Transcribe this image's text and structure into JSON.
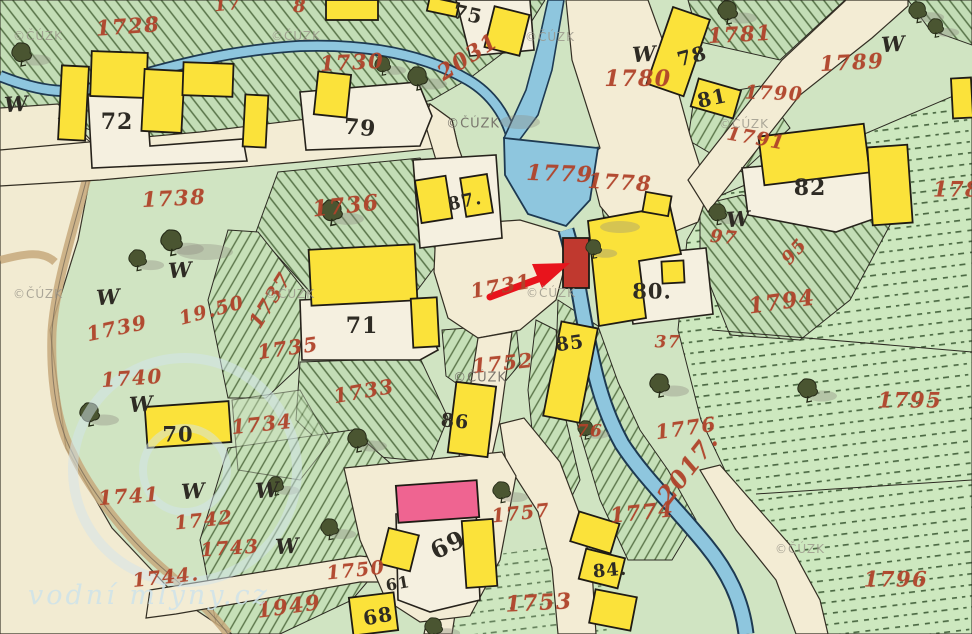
{
  "map": {
    "type": "historic-cadastral-map",
    "colors": {
      "building_wood_yellow": "#fbe23a",
      "building_masonry_pink": "#ef6491",
      "highlight_building_red": "#c0392f",
      "stream_blue": "#8ec6de",
      "field_green": "#cfe3bf",
      "road_cream": "#f3ecd4",
      "parcel_number_red": "#b0432a",
      "house_number_black": "#2e2b24",
      "arrow_red": "#e8141c"
    },
    "parcel_numbers_red": [
      {
        "t": "1728",
        "x": 128,
        "y": 26,
        "r": -4,
        "s": 21
      },
      {
        "t": "17",
        "x": 228,
        "y": 5,
        "r": -5,
        "s": 18
      },
      {
        "t": "8",
        "x": 300,
        "y": 7,
        "r": 0,
        "s": 18
      },
      {
        "t": "1730",
        "x": 352,
        "y": 62,
        "r": -3,
        "s": 21
      },
      {
        "t": "2031",
        "x": 468,
        "y": 57,
        "r": -33,
        "s": 22
      },
      {
        "t": "1779",
        "x": 560,
        "y": 174,
        "r": 2,
        "s": 22
      },
      {
        "t": "1778",
        "x": 620,
        "y": 182,
        "r": 3,
        "s": 21
      },
      {
        "t": "1780",
        "x": 638,
        "y": 79,
        "r": 0,
        "s": 22
      },
      {
        "t": "1781",
        "x": 740,
        "y": 34,
        "r": -3,
        "s": 21
      },
      {
        "t": "1789",
        "x": 852,
        "y": 62,
        "r": -3,
        "s": 21
      },
      {
        "t": "1790",
        "x": 774,
        "y": 94,
        "r": 2,
        "s": 19
      },
      {
        "t": "1791",
        "x": 756,
        "y": 139,
        "r": 10,
        "s": 19
      },
      {
        "t": "178",
        "x": 957,
        "y": 189,
        "r": 0,
        "s": 21
      },
      {
        "t": "97",
        "x": 724,
        "y": 238,
        "r": 5,
        "s": 18
      },
      {
        "t": "95",
        "x": 795,
        "y": 252,
        "r": -48,
        "s": 18
      },
      {
        "t": "1794",
        "x": 782,
        "y": 302,
        "r": -8,
        "s": 22
      },
      {
        "t": "1795",
        "x": 910,
        "y": 400,
        "r": 0,
        "s": 21
      },
      {
        "t": "1796",
        "x": 896,
        "y": 579,
        "r": 0,
        "s": 21
      },
      {
        "t": "1736",
        "x": 346,
        "y": 206,
        "r": -6,
        "s": 22
      },
      {
        "t": "1737",
        "x": 270,
        "y": 300,
        "r": -58,
        "s": 20
      },
      {
        "t": "1735",
        "x": 288,
        "y": 348,
        "r": -8,
        "s": 20
      },
      {
        "t": "1738",
        "x": 174,
        "y": 198,
        "r": -3,
        "s": 21
      },
      {
        "t": "1739",
        "x": 117,
        "y": 328,
        "r": -12,
        "s": 20
      },
      {
        "t": "19.50",
        "x": 212,
        "y": 311,
        "r": -15,
        "s": 19
      },
      {
        "t": "1740",
        "x": 132,
        "y": 378,
        "r": -4,
        "s": 20
      },
      {
        "t": "1741",
        "x": 129,
        "y": 496,
        "r": -4,
        "s": 20
      },
      {
        "t": "1742",
        "x": 204,
        "y": 521,
        "r": -6,
        "s": 19
      },
      {
        "t": "1743",
        "x": 230,
        "y": 549,
        "r": -4,
        "s": 19
      },
      {
        "t": "1744.",
        "x": 166,
        "y": 578,
        "r": -6,
        "s": 19
      },
      {
        "t": "1949",
        "x": 289,
        "y": 606,
        "r": -8,
        "s": 21
      },
      {
        "t": "1734",
        "x": 262,
        "y": 424,
        "r": -6,
        "s": 20
      },
      {
        "t": "1733",
        "x": 364,
        "y": 391,
        "r": -10,
        "s": 20
      },
      {
        "t": "1731",
        "x": 501,
        "y": 286,
        "r": -10,
        "s": 20
      },
      {
        "t": "1752",
        "x": 503,
        "y": 363,
        "r": -6,
        "s": 20
      },
      {
        "t": "76",
        "x": 590,
        "y": 432,
        "r": 0,
        "s": 17
      },
      {
        "t": "37",
        "x": 668,
        "y": 343,
        "r": 0,
        "s": 17
      },
      {
        "t": "1776",
        "x": 686,
        "y": 428,
        "r": -8,
        "s": 20
      },
      {
        "t": "2017.",
        "x": 688,
        "y": 468,
        "r": -52,
        "s": 24
      },
      {
        "t": "1774",
        "x": 642,
        "y": 512,
        "r": -6,
        "s": 21
      },
      {
        "t": "1757",
        "x": 521,
        "y": 514,
        "r": -6,
        "s": 19
      },
      {
        "t": "1750",
        "x": 356,
        "y": 571,
        "r": -6,
        "s": 19
      },
      {
        "t": "1753",
        "x": 539,
        "y": 603,
        "r": -3,
        "s": 22
      }
    ],
    "house_numbers_black": [
      {
        "t": "72",
        "x": 117,
        "y": 122,
        "r": 0,
        "s": 22
      },
      {
        "t": "75",
        "x": 468,
        "y": 14,
        "r": 12,
        "s": 20
      },
      {
        "t": "79",
        "x": 360,
        "y": 128,
        "r": 5,
        "s": 22
      },
      {
        "t": "87.",
        "x": 465,
        "y": 202,
        "r": -12,
        "s": 18
      },
      {
        "t": "78",
        "x": 692,
        "y": 56,
        "r": -15,
        "s": 20
      },
      {
        "t": "81",
        "x": 712,
        "y": 98,
        "r": -12,
        "s": 20
      },
      {
        "t": "82",
        "x": 810,
        "y": 188,
        "r": 0,
        "s": 22
      },
      {
        "t": "80.",
        "x": 652,
        "y": 291,
        "r": 0,
        "s": 21
      },
      {
        "t": "71",
        "x": 362,
        "y": 326,
        "r": 0,
        "s": 22
      },
      {
        "t": "86",
        "x": 455,
        "y": 422,
        "r": 5,
        "s": 19
      },
      {
        "t": "85",
        "x": 570,
        "y": 344,
        "r": -8,
        "s": 19
      },
      {
        "t": "70",
        "x": 178,
        "y": 434,
        "r": 0,
        "s": 21
      },
      {
        "t": "69",
        "x": 448,
        "y": 545,
        "r": -25,
        "s": 24
      },
      {
        "t": "61",
        "x": 398,
        "y": 584,
        "r": -10,
        "s": 16
      },
      {
        "t": "68",
        "x": 378,
        "y": 616,
        "r": -10,
        "s": 20
      },
      {
        "t": "84.",
        "x": 610,
        "y": 571,
        "r": -5,
        "s": 18
      }
    ],
    "meadow_symbols": {
      "glyph": "W",
      "positions": [
        [
          16,
          104
        ],
        [
          644,
          54
        ],
        [
          893,
          44
        ],
        [
          738,
          219
        ],
        [
          180,
          270
        ],
        [
          108,
          297
        ],
        [
          141,
          404
        ],
        [
          193,
          491
        ],
        [
          267,
          490
        ],
        [
          287,
          546
        ]
      ]
    },
    "watermarks": {
      "cuzk": {
        "text": "©ČÚZK",
        "positions": [
          [
            38,
            36
          ],
          [
            296,
            36
          ],
          [
            550,
            37
          ],
          [
            744,
            124
          ],
          [
            290,
            294
          ],
          [
            551,
            293
          ],
          [
            38,
            294
          ],
          [
            800,
            549
          ]
        ],
        "dark_positions": [
          [
            473,
            124
          ],
          [
            480,
            378
          ]
        ]
      },
      "site": {
        "text": "vodní mlýny.cz"
      }
    },
    "annotation_arrow": {
      "color": "#e8141c",
      "target": "red-building-at-stream",
      "shaft": [
        490,
        297,
        541,
        278
      ],
      "head_points": "570,263 532,264 542,288"
    }
  }
}
